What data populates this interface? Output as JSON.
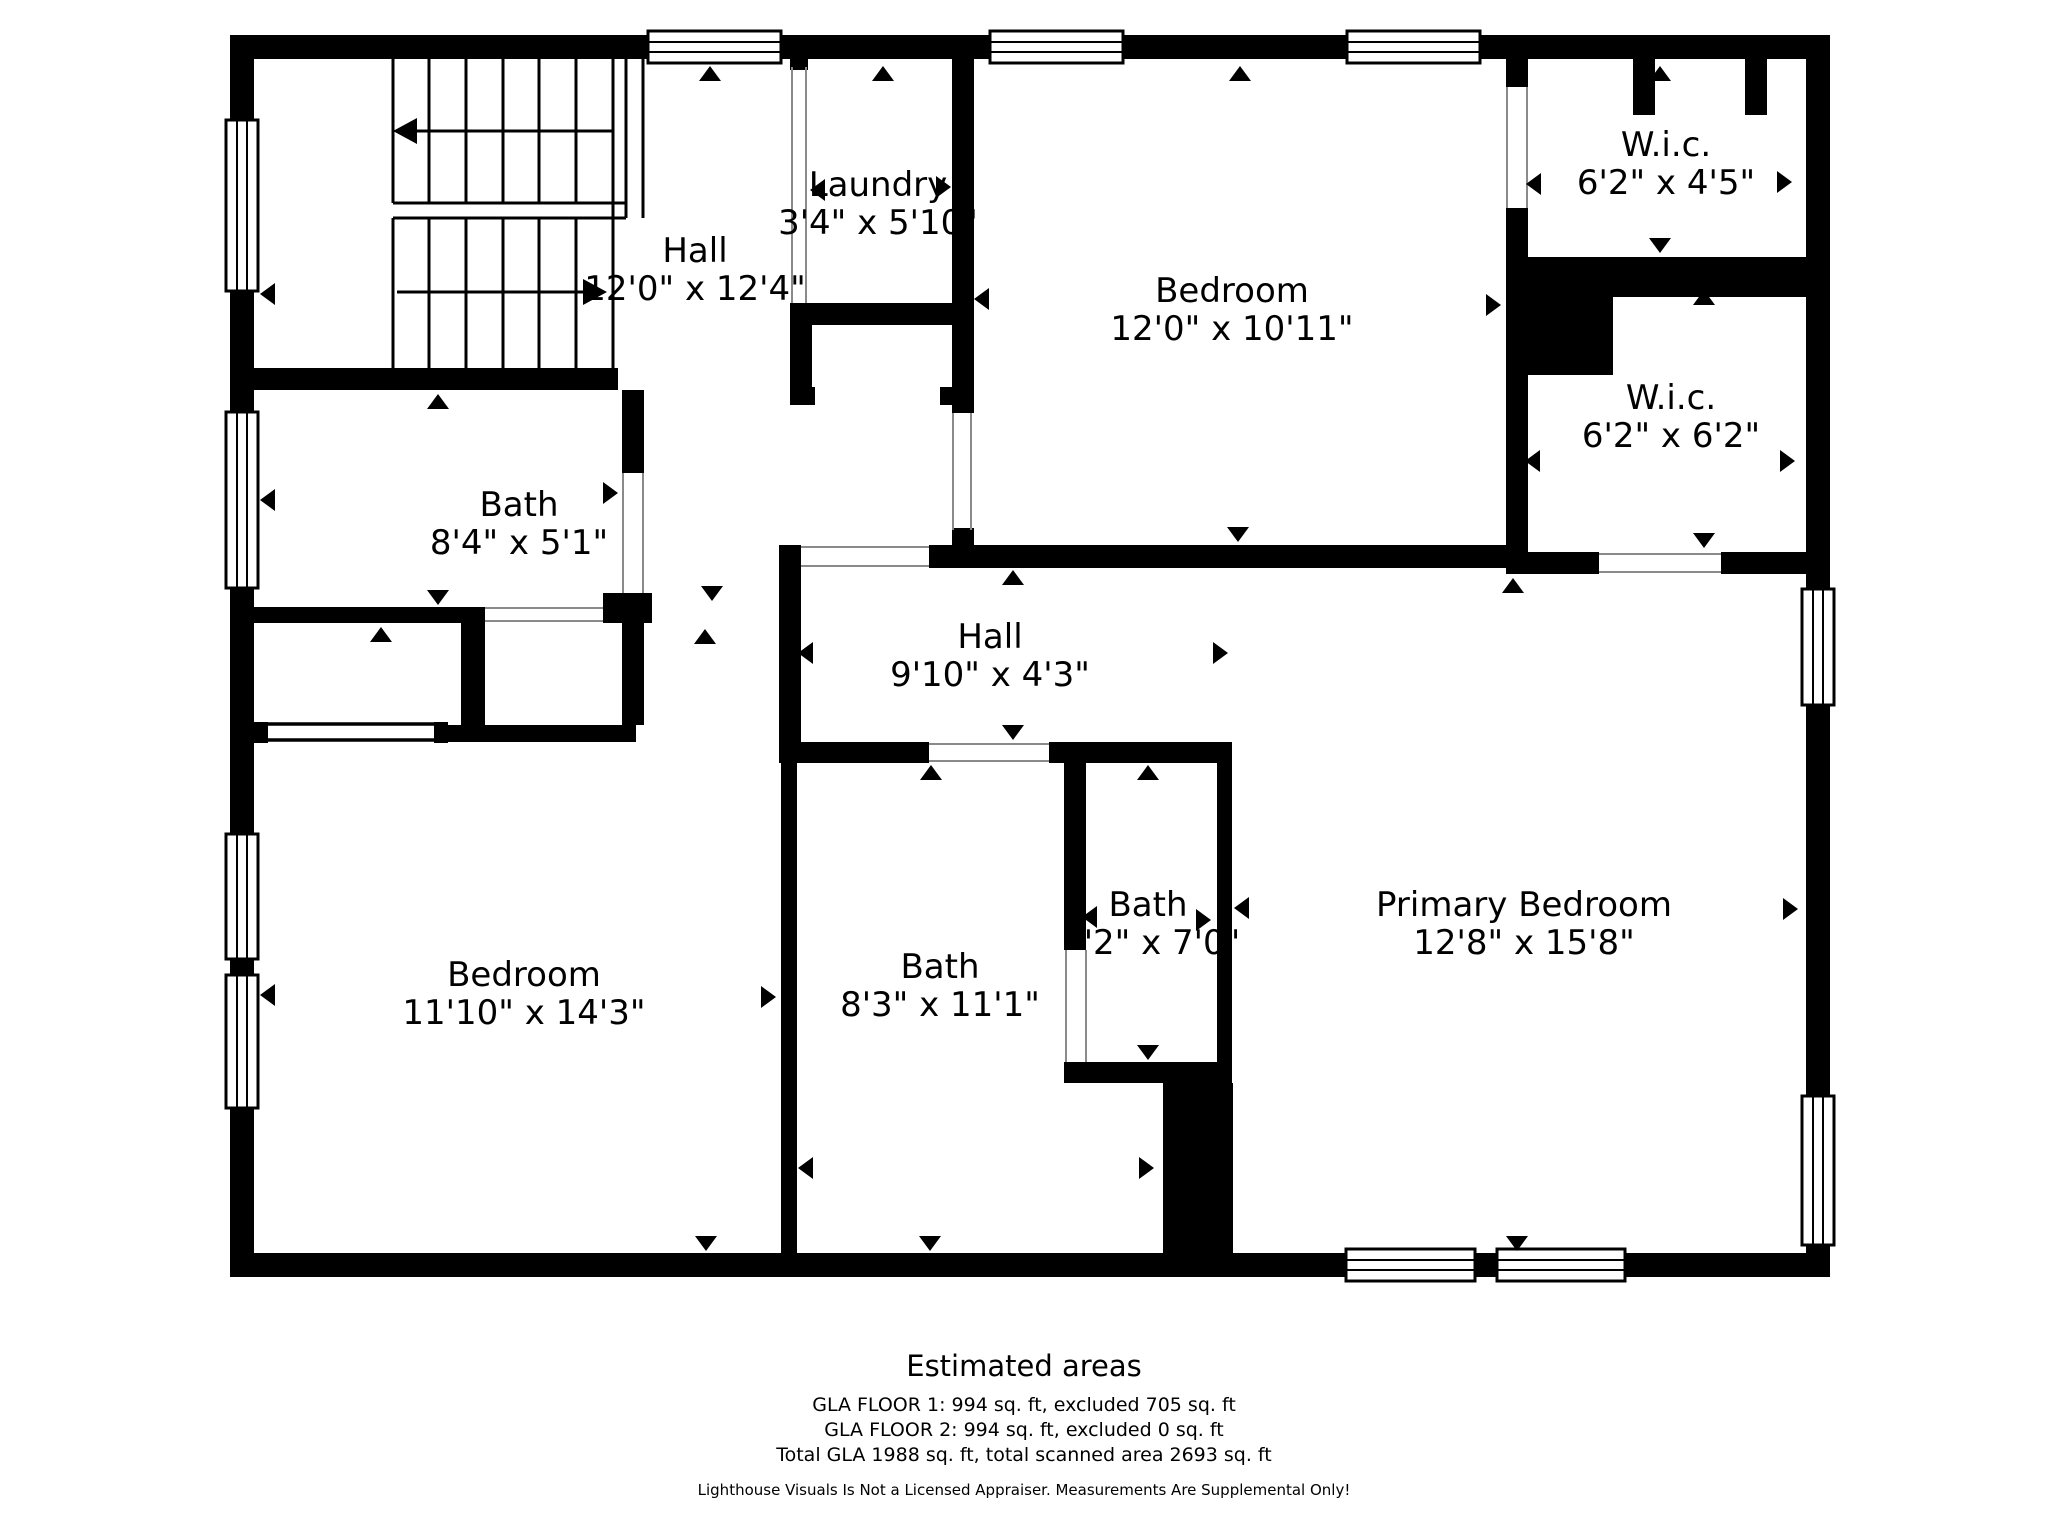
{
  "colors": {
    "wall": "#000000",
    "background": "#ffffff"
  },
  "floor_plan": {
    "rooms": [
      {
        "name": "Hall",
        "dims": "12'0\" x 12'4\"",
        "x": 695,
        "y": 262
      },
      {
        "name": "Laundry",
        "dims": "3'4\" x 5'10\"",
        "x": 878,
        "y": 196
      },
      {
        "name": "Bedroom",
        "dims": "12'0\" x 10'11\"",
        "x": 1232,
        "y": 302
      },
      {
        "name": "W.i.c.",
        "dims": "6'2\" x 4'5\"",
        "x": 1666,
        "y": 156
      },
      {
        "name": "W.i.c.",
        "dims": "6'2\" x 6'2\"",
        "x": 1671,
        "y": 409
      },
      {
        "name": "Bath",
        "dims": "8'4\" x 5'1\"",
        "x": 519,
        "y": 516
      },
      {
        "name": "Hall",
        "dims": "9'10\" x 4'3\"",
        "x": 990,
        "y": 648
      },
      {
        "name": "Bedroom",
        "dims": "11'10\" x 14'3\"",
        "x": 524,
        "y": 986
      },
      {
        "name": "Bath",
        "dims": "8'3\" x 11'1\"",
        "x": 940,
        "y": 978
      },
      {
        "name": "Bath",
        "dims": "'2\" x 7'0\"",
        "x": 1148,
        "y": 916,
        "dims_x": 1162
      },
      {
        "name": "Primary Bedroom",
        "dims": "12'8\" x 15'8\"",
        "x": 1524,
        "y": 916
      }
    ],
    "measurement_markers": [
      {
        "dir": "up",
        "x": 710,
        "y": 66
      },
      {
        "dir": "up",
        "x": 883,
        "y": 66
      },
      {
        "dir": "up",
        "x": 1240,
        "y": 66
      },
      {
        "dir": "up",
        "x": 1660,
        "y": 66
      },
      {
        "dir": "up",
        "x": 438,
        "y": 394
      },
      {
        "dir": "up",
        "x": 1704,
        "y": 290
      },
      {
        "dir": "up",
        "x": 931,
        "y": 765
      },
      {
        "dir": "up",
        "x": 1148,
        "y": 765
      },
      {
        "dir": "up",
        "x": 1013,
        "y": 570
      },
      {
        "dir": "up",
        "x": 381,
        "y": 627
      },
      {
        "dir": "up",
        "x": 705,
        "y": 629
      },
      {
        "dir": "up",
        "x": 1513,
        "y": 578
      },
      {
        "dir": "down",
        "x": 880,
        "y": 319
      },
      {
        "dir": "down",
        "x": 1660,
        "y": 253
      },
      {
        "dir": "down",
        "x": 1704,
        "y": 548
      },
      {
        "dir": "down",
        "x": 1238,
        "y": 542
      },
      {
        "dir": "down",
        "x": 1013,
        "y": 740
      },
      {
        "dir": "down",
        "x": 438,
        "y": 605
      },
      {
        "dir": "down",
        "x": 712,
        "y": 601
      },
      {
        "dir": "down",
        "x": 1148,
        "y": 1060
      },
      {
        "dir": "down",
        "x": 706,
        "y": 1251
      },
      {
        "dir": "down",
        "x": 930,
        "y": 1251
      },
      {
        "dir": "down",
        "x": 1517,
        "y": 1251
      },
      {
        "dir": "left",
        "x": 260,
        "y": 294
      },
      {
        "dir": "left",
        "x": 260,
        "y": 500
      },
      {
        "dir": "left",
        "x": 260,
        "y": 995
      },
      {
        "dir": "left",
        "x": 810,
        "y": 190
      },
      {
        "dir": "left",
        "x": 974,
        "y": 299
      },
      {
        "dir": "left",
        "x": 1526,
        "y": 184
      },
      {
        "dir": "left",
        "x": 1525,
        "y": 461
      },
      {
        "dir": "left",
        "x": 798,
        "y": 653
      },
      {
        "dir": "left",
        "x": 798,
        "y": 1168
      },
      {
        "dir": "left",
        "x": 1082,
        "y": 917
      },
      {
        "dir": "left",
        "x": 1234,
        "y": 908
      },
      {
        "dir": "right",
        "x": 951,
        "y": 187
      },
      {
        "dir": "right",
        "x": 1501,
        "y": 305
      },
      {
        "dir": "right",
        "x": 1792,
        "y": 182
      },
      {
        "dir": "right",
        "x": 1795,
        "y": 461
      },
      {
        "dir": "right",
        "x": 1228,
        "y": 653
      },
      {
        "dir": "right",
        "x": 1211,
        "y": 920
      },
      {
        "dir": "right",
        "x": 776,
        "y": 997
      },
      {
        "dir": "right",
        "x": 1154,
        "y": 1168
      },
      {
        "dir": "right",
        "x": 1798,
        "y": 909
      },
      {
        "dir": "right",
        "x": 618,
        "y": 493
      }
    ],
    "stair_arrows": [
      {
        "name": "upper-flight-arrow",
        "direction": "left"
      },
      {
        "name": "lower-flight-arrow",
        "direction": "right"
      }
    ]
  },
  "footer": {
    "title": "Estimated areas",
    "gla_floor_1": "GLA FLOOR 1: 994 sq. ft, excluded 705 sq. ft",
    "gla_floor_2": "GLA FLOOR 2: 994 sq. ft, excluded 0 sq. ft",
    "gla_total": "Total GLA 1988 sq. ft, total scanned area 2693 sq. ft",
    "disclaimer": "Lighthouse Visuals Is Not a Licensed Appraiser. Measurements Are Supplemental Only!"
  }
}
